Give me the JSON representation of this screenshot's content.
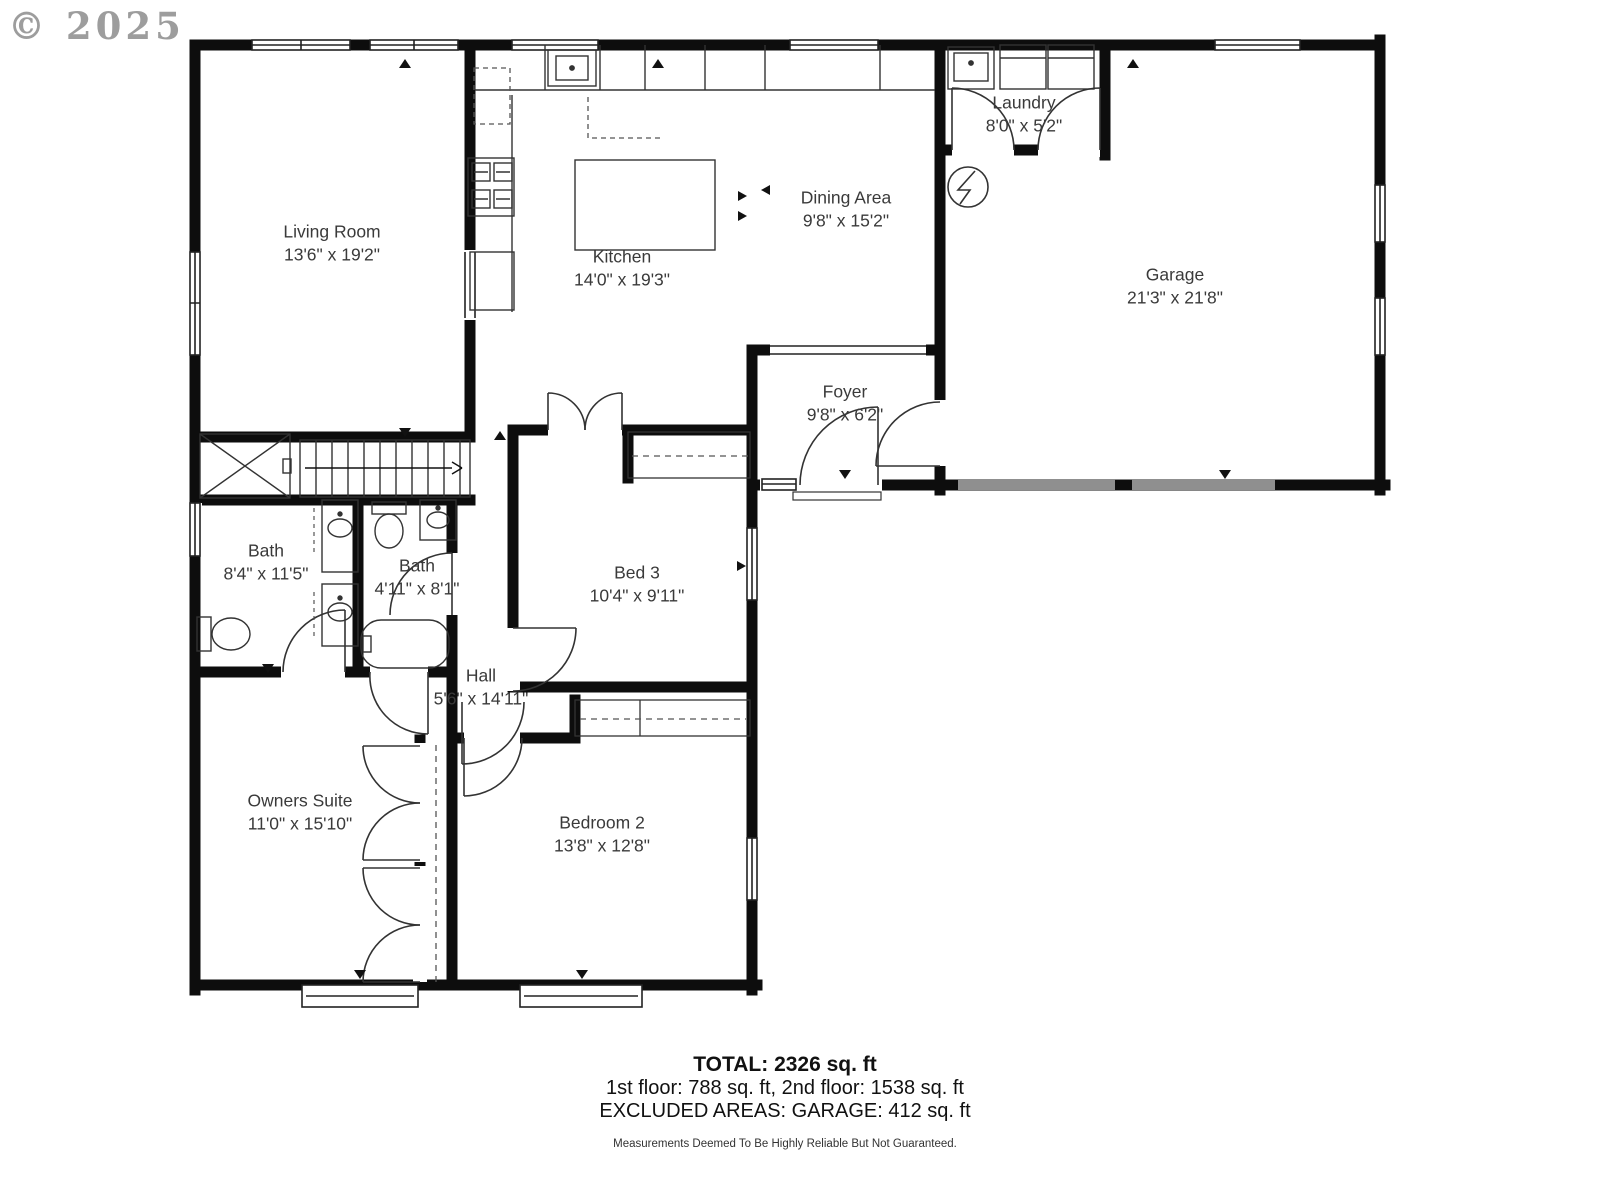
{
  "copyright": {
    "text": "© 2025"
  },
  "colors": {
    "wall": "#0d0d0d",
    "thin_line": "#222222",
    "label_text": "#3a3a3a",
    "garage_door": "#8f8f8f",
    "copyright_gray": "#8d8d8d"
  },
  "rooms": {
    "living": {
      "name": "Living Room",
      "dims": "13'6\" x 19'2\""
    },
    "kitchen": {
      "name": "Kitchen",
      "dims": "14'0\" x 19'3\""
    },
    "dining": {
      "name": "Dining Area",
      "dims": "9'8\" x 15'2\""
    },
    "laundry": {
      "name": "Laundry",
      "dims": "8'0\" x 5'2\""
    },
    "garage": {
      "name": "Garage",
      "dims": "21'3\" x 21'8\""
    },
    "foyer": {
      "name": "Foyer",
      "dims": "9'8\" x 6'2\""
    },
    "bath_main": {
      "name": "Bath",
      "dims": "8'4\" x 11'5\""
    },
    "bath_hall": {
      "name": "Bath",
      "dims": "4'11\" x 8'1\""
    },
    "bed3": {
      "name": "Bed 3",
      "dims": "10'4\" x 9'11\""
    },
    "hall": {
      "name": "Hall",
      "dims": "5'6\" x 14'11\""
    },
    "owners": {
      "name": "Owners Suite",
      "dims": "11'0\" x 15'10\""
    },
    "bedroom2": {
      "name": "Bedroom 2",
      "dims": "13'8\" x 12'8\""
    }
  },
  "summary": {
    "total": "TOTAL: 2326 sq. ft",
    "floors": "1st floor: 788 sq. ft, 2nd floor: 1538 sq. ft",
    "excluded": "EXCLUDED AREAS:  GARAGE: 412 sq. ft",
    "disclaimer": "Measurements Deemed To Be Highly Reliable But Not Guaranteed."
  }
}
